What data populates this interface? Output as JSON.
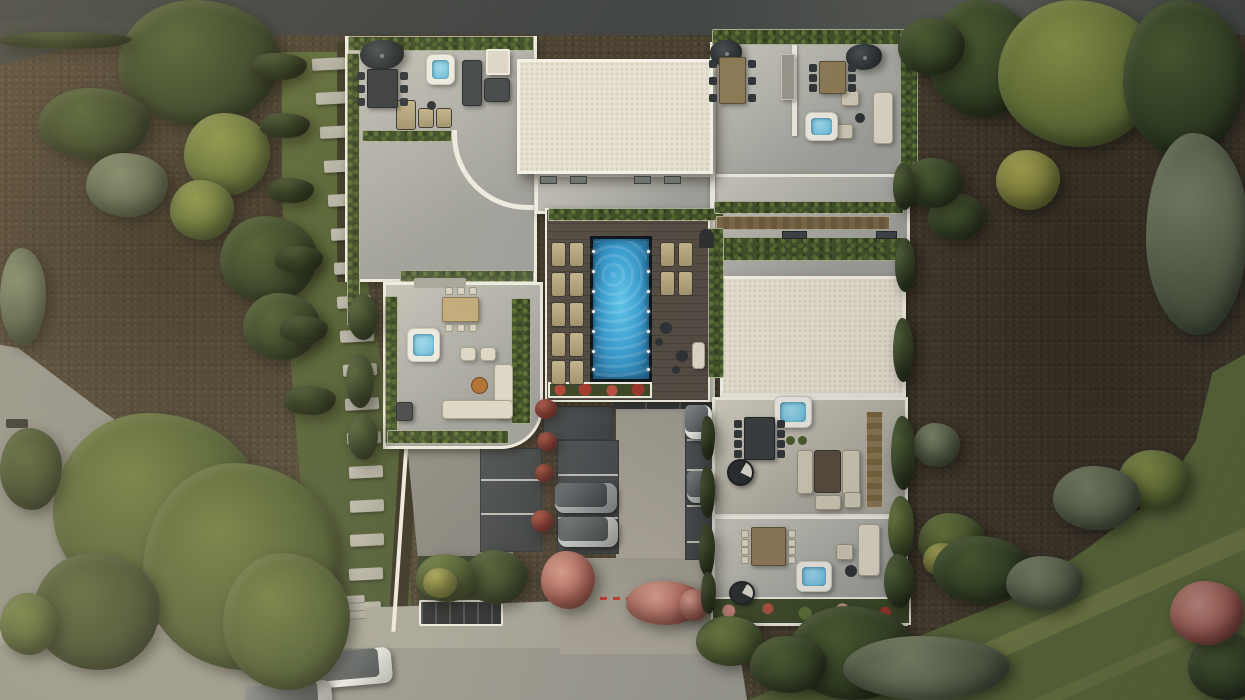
{
  "meta": {
    "title": "Aerial top-down architectural render of a modern villa complex with rooftop terraces, central pool, parking court and landscaped gardens",
    "canvas": {
      "width": 1245,
      "height": 700
    }
  },
  "palette": {
    "earth": "#4a4031",
    "asphalt": "#3c403e",
    "road": "#8e8f88",
    "sidewalk": "#b0afa4",
    "grass": "#57653a",
    "lawn": "#5a683b",
    "stonePath": "#b5b2a7",
    "terrace": "#b6b6b0",
    "wall": "#edeadf",
    "roof": "#e8e2d2",
    "deck": "#554d44",
    "hedge": "#41502a",
    "poolRim": "#0f171d",
    "pool1": "#62c6ea",
    "pool2": "#3d9fd0",
    "pool3": "#2a7aa8",
    "tub": "#eceae1",
    "tubWater": "#7cc6e0",
    "parking": "#43474a",
    "parkLine": "#cfcec6",
    "woodTable": "#8d7b57",
    "darkFurn": "#3a3e40",
    "sofa": "#ddd7c7",
    "beige": "#cfc8b5",
    "flowerRed": "#a33b2e",
    "flowerPink": "#c08276"
  },
  "scene": {
    "pool": {
      "lights_x": [
        592,
        647
      ],
      "lights_y": [
        250,
        270,
        290,
        310,
        330,
        350,
        368
      ],
      "lounger_size": [
        15,
        25
      ],
      "loungers_left": {
        "cols": [
          551,
          569
        ],
        "rows": [
          242,
          272,
          302,
          332,
          360
        ]
      },
      "loungers_right": {
        "cols": [
          660,
          678
        ],
        "rows": [
          242,
          271
        ]
      }
    },
    "stepping_stones": {
      "size": [
        34,
        12
      ],
      "points": [
        [
          312,
          58
        ],
        [
          316,
          92
        ],
        [
          320,
          126
        ],
        [
          324,
          160
        ],
        [
          328,
          194
        ],
        [
          331,
          228
        ],
        [
          334,
          262
        ],
        [
          337,
          296
        ],
        [
          340,
          330
        ],
        [
          343,
          364
        ],
        [
          345,
          398
        ],
        [
          347,
          432
        ],
        [
          349,
          466
        ],
        [
          350,
          500
        ],
        [
          350,
          534
        ],
        [
          349,
          568
        ],
        [
          347,
          602
        ],
        [
          344,
          632
        ]
      ]
    },
    "stall_lines": [
      {
        "x": 481,
        "w": 60,
        "ys": [
          479,
          513
        ]
      },
      {
        "x": 558,
        "w": 60,
        "ys": [
          474,
          517
        ]
      },
      {
        "x": 687,
        "w": 26,
        "ys": [
          439,
          469,
          505,
          541
        ]
      }
    ],
    "cars": [
      {
        "name": "street-car-white",
        "x": 310,
        "y": 650,
        "w": 82,
        "h": 36,
        "rot": -5,
        "body": "#e9ebe7",
        "glass": "#555d60"
      },
      {
        "name": "street-car-partial",
        "x": 246,
        "y": 683,
        "w": 86,
        "h": 28,
        "rot": -5,
        "body": "#c6c7c3",
        "glass": "#596063"
      },
      {
        "name": "parking-suv-gray",
        "x": 555,
        "y": 483,
        "w": 62,
        "h": 30,
        "rot": 0,
        "body": "#969b9d",
        "glass": "#3f474b"
      },
      {
        "name": "parking-car-silver",
        "x": 558,
        "y": 517,
        "w": 60,
        "h": 30,
        "rot": 0,
        "body": "#b9bcba",
        "glass": "#4a5255"
      },
      {
        "name": "stall-car-white",
        "x": 685,
        "y": 405,
        "w": 27,
        "h": 34,
        "rot": 0,
        "body": "#e4e6e2",
        "glass": "#5a6164"
      },
      {
        "name": "stall-car-silver",
        "x": 687,
        "y": 471,
        "w": 27,
        "h": 32,
        "rot": 0,
        "body": "#aab0af",
        "glass": "#4c5356"
      }
    ],
    "hot_tubs": [
      {
        "x": 426,
        "y": 54,
        "w": 29,
        "h": 31
      },
      {
        "x": 805,
        "y": 112,
        "w": 33,
        "h": 29
      },
      {
        "x": 407,
        "y": 328,
        "w": 33,
        "h": 34
      },
      {
        "x": 774,
        "y": 396,
        "w": 38,
        "h": 32
      },
      {
        "x": 796,
        "y": 561,
        "w": 36,
        "h": 31
      }
    ],
    "dining_tables": [
      {
        "x": 367,
        "y": 69,
        "w": 31,
        "h": 39,
        "top": "dark",
        "chairs": 6,
        "chair": "dark"
      },
      {
        "x": 719,
        "y": 57,
        "w": 27,
        "h": 47,
        "top": "wood",
        "chairs": 6,
        "chair": "dark"
      },
      {
        "x": 819,
        "y": 61,
        "w": 27,
        "h": 33,
        "top": "wood",
        "chairs": 6,
        "chair": "dark"
      },
      {
        "x": 442,
        "y": 297,
        "w": 37,
        "h": 25,
        "top": "tan",
        "chairs": 6,
        "chair": "light"
      },
      {
        "x": 744,
        "y": 417,
        "w": 31,
        "h": 43,
        "top": "dark",
        "chairs": 8,
        "chair": "dark"
      },
      {
        "x": 751,
        "y": 527,
        "w": 35,
        "h": 39,
        "top": "wood",
        "chairs": 8,
        "chair": "light"
      }
    ],
    "vegetation": [
      [
        "g-dark",
        118,
        0,
        162,
        126
      ],
      [
        "g-dark",
        38,
        88,
        112,
        72
      ],
      [
        "g-sun",
        184,
        113,
        86,
        82
      ],
      [
        "g-sun",
        170,
        180,
        64,
        60
      ],
      [
        "olive",
        86,
        153,
        82,
        64
      ],
      [
        "g-dark",
        220,
        216,
        97,
        87
      ],
      [
        "g-dark",
        243,
        293,
        77,
        67
      ],
      [
        "olive",
        0,
        248,
        46,
        97
      ],
      [
        "hedge-dark",
        250,
        53,
        57,
        27
      ],
      [
        "hedge-dark",
        260,
        113,
        50,
        25
      ],
      [
        "hedge-dark",
        268,
        178,
        46,
        25
      ],
      [
        "hedge-dark",
        275,
        246,
        48,
        27
      ],
      [
        "hedge-dark",
        280,
        316,
        48,
        27
      ],
      [
        "hedge-dark",
        284,
        386,
        52,
        29
      ],
      [
        "g-mid",
        53,
        413,
        207,
        192
      ],
      [
        "g-mid",
        143,
        463,
        197,
        207
      ],
      [
        "g-dark",
        33,
        553,
        127,
        117
      ],
      [
        "g-mid",
        223,
        553,
        127,
        137
      ],
      [
        "g-dark",
        0,
        428,
        62,
        82
      ],
      [
        "g-mid",
        0,
        593,
        57,
        62
      ],
      [
        "g-dark",
        928,
        0,
        107,
        117
      ],
      [
        "g-sun",
        998,
        0,
        162,
        147
      ],
      [
        "g-dark",
        1123,
        0,
        122,
        157
      ],
      [
        "olive",
        1146,
        133,
        102,
        202
      ],
      [
        "g-yellow",
        996,
        150,
        64,
        60
      ],
      [
        "g-dark",
        928,
        193,
        57,
        47
      ],
      [
        "g-dark",
        898,
        18,
        67,
        57
      ],
      [
        "g-dark",
        903,
        158,
        60,
        50
      ],
      [
        "olive",
        913,
        423,
        47,
        44
      ],
      [
        "g-mid",
        918,
        513,
        67,
        57
      ],
      [
        "g-yellow",
        923,
        543,
        40,
        34
      ],
      [
        "g-sun",
        1118,
        450,
        72,
        60
      ],
      [
        "olive",
        1053,
        466,
        87,
        64
      ],
      [
        "g-dark",
        933,
        536,
        97,
        67
      ],
      [
        "olive",
        1006,
        556,
        77,
        54
      ],
      [
        "g-dark",
        1188,
        633,
        77,
        67
      ],
      [
        "g-dark",
        788,
        606,
        127,
        94
      ],
      [
        "olive",
        843,
        636,
        167,
        64
      ],
      [
        "g-mid",
        696,
        616,
        67,
        50
      ],
      [
        "g-dark",
        750,
        636,
        77,
        57
      ],
      [
        "flower-pink",
        1170,
        581,
        74,
        64
      ],
      [
        "flower-pink",
        541,
        551,
        54,
        58
      ],
      [
        "flower-pink",
        626,
        581,
        78,
        44
      ],
      [
        "flower-pink",
        679,
        589,
        30,
        32
      ],
      [
        "flower-red",
        535,
        399,
        22,
        20
      ],
      [
        "flower-red",
        537,
        432,
        20,
        19
      ],
      [
        "flower-red",
        535,
        464,
        18,
        18
      ],
      [
        "flower-red",
        531,
        510,
        22,
        22
      ],
      [
        "g-dark",
        464,
        550,
        64,
        54
      ],
      [
        "g-mid",
        416,
        554,
        60,
        48
      ],
      [
        "g-yellow",
        423,
        568,
        34,
        30
      ],
      [
        "g-dark",
        348,
        294,
        30,
        46
      ],
      [
        "g-dark",
        346,
        354,
        28,
        54
      ],
      [
        "g-dark",
        348,
        414,
        30,
        46
      ],
      [
        "hedge-dark",
        0,
        32,
        132,
        17
      ],
      [
        "g-dark",
        893,
        163,
        22,
        47
      ],
      [
        "g-dark",
        895,
        238,
        20,
        54
      ],
      [
        "g-dark",
        893,
        318,
        20,
        64
      ],
      [
        "g-dark",
        891,
        416,
        24,
        74
      ],
      [
        "g-mid",
        888,
        496,
        26,
        64
      ],
      [
        "g-dark",
        884,
        554,
        30,
        54
      ],
      [
        "hedge-dark",
        701,
        416,
        14,
        44
      ],
      [
        "hedge-dark",
        700,
        466,
        15,
        52
      ],
      [
        "hedge-dark",
        699,
        524,
        16,
        52
      ],
      [
        "hedge-dark",
        701,
        572,
        15,
        42
      ]
    ]
  }
}
